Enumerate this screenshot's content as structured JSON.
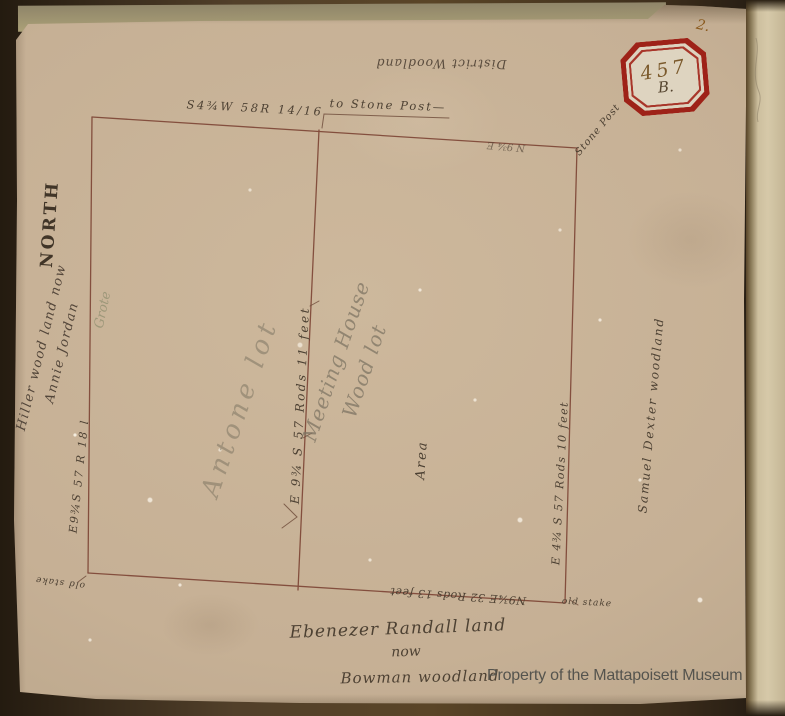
{
  "photo": {
    "watermark": "Property of the Mattapoisett Museum",
    "page_number": "2.",
    "stamp": {
      "number": "457",
      "letter": "B."
    },
    "colors": {
      "paper": "#c6b095",
      "ink": "#4d4133",
      "survey_line": "#7c4434",
      "stamp_red": "#9e2218",
      "pencil": "#7d7463",
      "watermark_gray": "#55544e"
    }
  },
  "map": {
    "north_label": "NORTH",
    "top_outside_label": "District Woodland",
    "top_bearing": "S4¾W  58R 14/16",
    "top_to_post": "to Stone Post—",
    "top_inside_bearing": "N 9¾ E",
    "corner_post_label": "Stone Post",
    "left_owner_line1": "Hiller wood land now",
    "left_owner_line2": "Annie Jordan",
    "left_pencil_note": "Grote",
    "left_bearing": "E9¾S  57 R 18 l",
    "left_corner_stake": "old stake",
    "middle_bearing": "E 9¾ S  57 Rods 11 feet",
    "left_parcel_pencil": "Antone lot",
    "right_parcel_pencil_line1": "Meeting House",
    "right_parcel_pencil_line2": "Wood lot",
    "area_label": "Area",
    "right_bearing": "E 4¾ S  57 Rods 10 feet",
    "right_owner": "Samuel Dexter woodland",
    "bottom_bearing": "N9¾E  32 Rods 13 feet",
    "bottom_corner_stake": "old stake",
    "bottom_owner_line1": "Ebenezer Randall land",
    "bottom_owner_line2": "now",
    "bottom_owner_line3": "Bowman woodland"
  }
}
